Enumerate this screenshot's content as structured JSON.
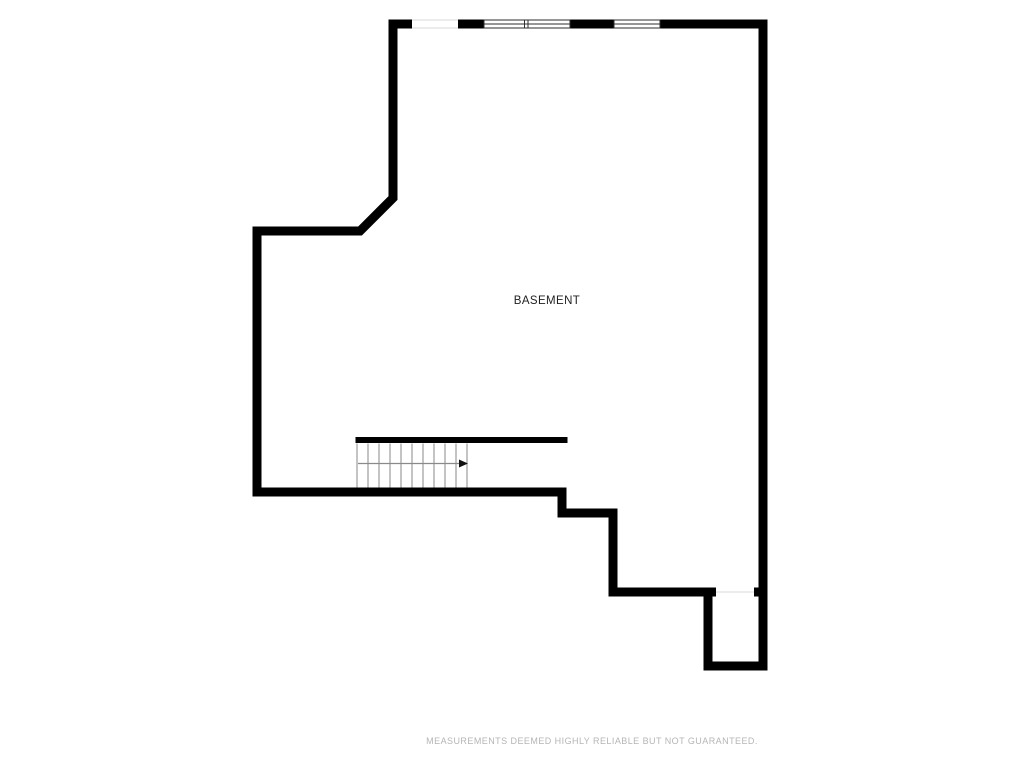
{
  "page": {
    "background_color": "#ffffff",
    "disclaimer_text": "MEASUREMENTS DEEMED HIGHLY RELIABLE BUT NOT GUARANTEED.",
    "disclaimer_color": "#b5b5b5"
  },
  "floorplan": {
    "room_label": "BASEMENT",
    "room_label_color": "#1f1f1f",
    "wall_color": "#000000",
    "window_frame_color": "#2e2e2e",
    "opening_line_color": "#d9d9d9",
    "stair_line_color": "#8a8a8a",
    "stair_arrow_color": "#111111",
    "stairs": {
      "tread_count": 10,
      "arrow_direction": "right"
    },
    "windows": {
      "top_wall_double_window_panes": 2,
      "top_wall_single_window_panes": 1
    }
  }
}
